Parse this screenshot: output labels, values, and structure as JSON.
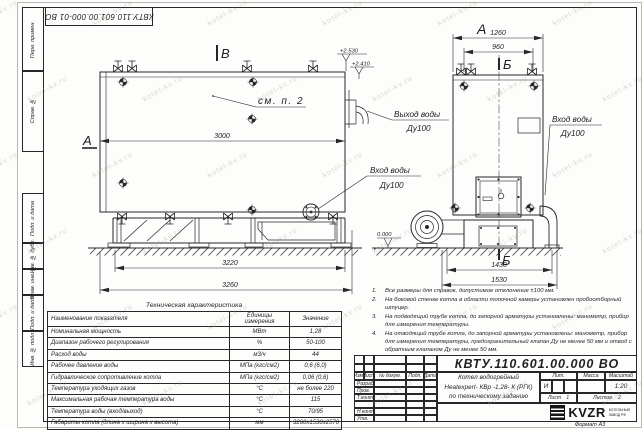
{
  "sheet": {
    "top_stamp": "КВТУ.110.601.00.000-01 ВО",
    "format_label": "Формат А3",
    "margin_labels": [
      "Перв. примен.",
      "Справ. №",
      "Подп. и дата",
      "Инв. № дубл.",
      "Взам. инв. №",
      "Подп. и дата",
      "Инв. № подл."
    ]
  },
  "drawing": {
    "section_v": "В",
    "section_a": "А",
    "view_a": "А",
    "section_b_top": "Б",
    "section_b_bottom": "Б",
    "see_note": "см. п. 2",
    "elev1": "+2.530",
    "elev2": "+2.410",
    "elev0": "0.000",
    "d3000": "3000",
    "d3220": "3220",
    "d3260": "3260",
    "d1260": "1260",
    "d960": "960",
    "d1430": "1430",
    "d1530": "1530",
    "outlet": "Выход воды",
    "inlet": "Вход воды",
    "dn": "Ду100"
  },
  "notes": {
    "items": [
      {
        "num": "1.",
        "text": "Все размеры для справок, допустимое отклонение ±100 мм."
      },
      {
        "num": "2.",
        "text": "На боковой стенке котла в области топочной камеры установлен пробоотборный штуцер."
      },
      {
        "num": "3.",
        "text": "На подводящий трубе котла, до запорной арматуры установлены: манометр, прибор для измерения температуры."
      },
      {
        "num": "4.",
        "text": "На отводящий трубе котла, до запорной арматуры установлены: манометр, прибор для измерения температуры, предохранительный клапан Ду не менее 50 мм и отвод с обратным клапаном Ду не менее 50 мм."
      }
    ]
  },
  "spec_table": {
    "title": "Техническая характеристика",
    "headers": [
      "Наименование показателя",
      "Единицы измерения",
      "Значение"
    ],
    "rows": [
      {
        "name": "Номинальная мощность",
        "unit": "МВт",
        "value": "1,28"
      },
      {
        "name": "Диапазон рабочего регулирования",
        "unit": "%",
        "value": "50-100"
      },
      {
        "name": "Расход воды",
        "unit": "м3/ч",
        "value": "44"
      },
      {
        "name": "Рабочее давление воды",
        "unit": "МПа (кгс/см2)",
        "value": "0,6 (6,0)"
      },
      {
        "name": "Гидравлическое сопротивление котла",
        "unit": "МПа (кгс/см2)",
        "value": "0,06 (0,6)"
      },
      {
        "name": "Температура уходящих газов",
        "unit": "°С",
        "value": "не более 220"
      },
      {
        "name": "Максимальная рабочая температура воды",
        "unit": "°С",
        "value": "115"
      },
      {
        "name": "Температура воды (вход/выход)",
        "unit": "°С",
        "value": "70/95"
      },
      {
        "name": "Габариты котла (длина х ширина х высота)",
        "unit": "мм",
        "value": "3260х1530х2570"
      }
    ]
  },
  "title_block": {
    "doc_number": "КВТУ.110.601.00.000  ВО",
    "product_line1": "Котел водогрейный",
    "product_line2": "Heatexpert- КВр -1,28- К (РГК)",
    "product_line3": "по техническому заданию",
    "col_izm": "Изм.",
    "col_list": "Лист",
    "col_doc": "№ докум.",
    "col_sign": "Подп.",
    "col_date": "Дата",
    "row_developed": "Разраб.",
    "row_checked": "Пров.",
    "row_tcontrol": "Т.контр.",
    "row_ncontrol": "Н.контр.",
    "row_approved": "Утв.",
    "lit_header": "Лит.",
    "mass_header": "Масса",
    "scale_header": "Масштаб",
    "lit_value": "И",
    "scale_value": "1:20",
    "sheet_label": "Лист",
    "sheet_value": "1",
    "sheets_label": "Листов",
    "sheets_value": "2",
    "logo_text": "KVZR",
    "logo_sub1": "КОТЕЛЬНЫЙ",
    "logo_sub2": "ЗАВОД РФ"
  },
  "watermark": {
    "text": "kotel-kv.ru"
  }
}
